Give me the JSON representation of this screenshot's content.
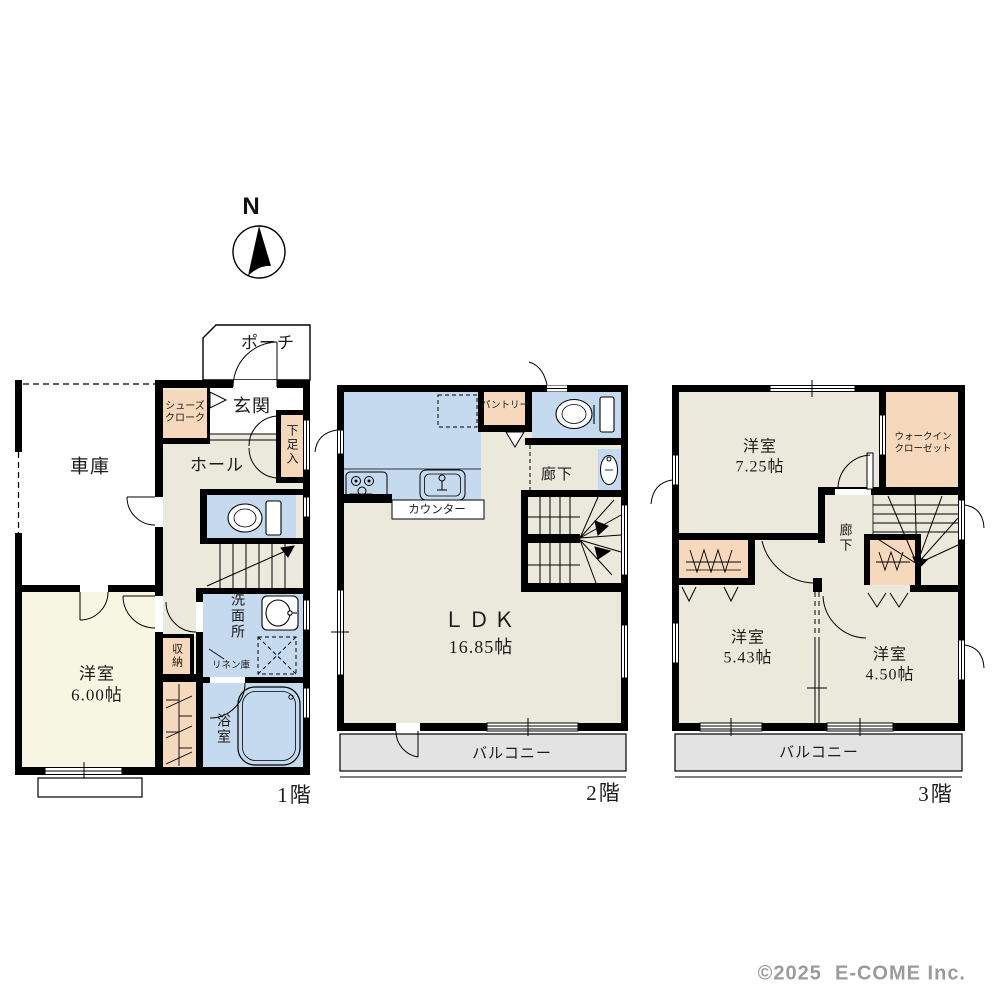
{
  "compass": {
    "label": "N"
  },
  "floor1": {
    "label": "1階",
    "rooms": {
      "porch": "ポーチ",
      "shoes_cloak": "シューズ\nクローク",
      "entrance": "玄関",
      "shoe_cabinet": "下足入",
      "hall": "ホール",
      "garage": "車庫",
      "western_room": "洋室\n6.00帖",
      "storage": "収納",
      "washroom": "洗面所",
      "linen": "リネン庫",
      "bathroom": "浴室"
    }
  },
  "floor2": {
    "label": "2階",
    "rooms": {
      "pantry": "パントリー",
      "counter": "カウンター",
      "corridor": "廊下",
      "ldk_name": "ＬＤＫ",
      "ldk_size": "16.85帖",
      "balcony": "バルコニー"
    }
  },
  "floor3": {
    "label": "3階",
    "rooms": {
      "western_room_1": "洋室\n7.25帖",
      "walk_in_closet": "ウォークイン\nクローゼット",
      "corridor": "廊下",
      "western_room_2": "洋室\n5.43帖",
      "western_room_3": "洋室\n4.50帖",
      "balcony": "バルコニー"
    }
  },
  "copyright": "©2025  E-COME Inc.",
  "colors": {
    "wall": "#000000",
    "room_beige": "#EBE9DC",
    "room_pale_yellow": "#F7F6E3",
    "water_blue": "#C5DAEE",
    "closet_peach": "#F6D8BC",
    "balcony_gray": "#E3E3E3"
  }
}
